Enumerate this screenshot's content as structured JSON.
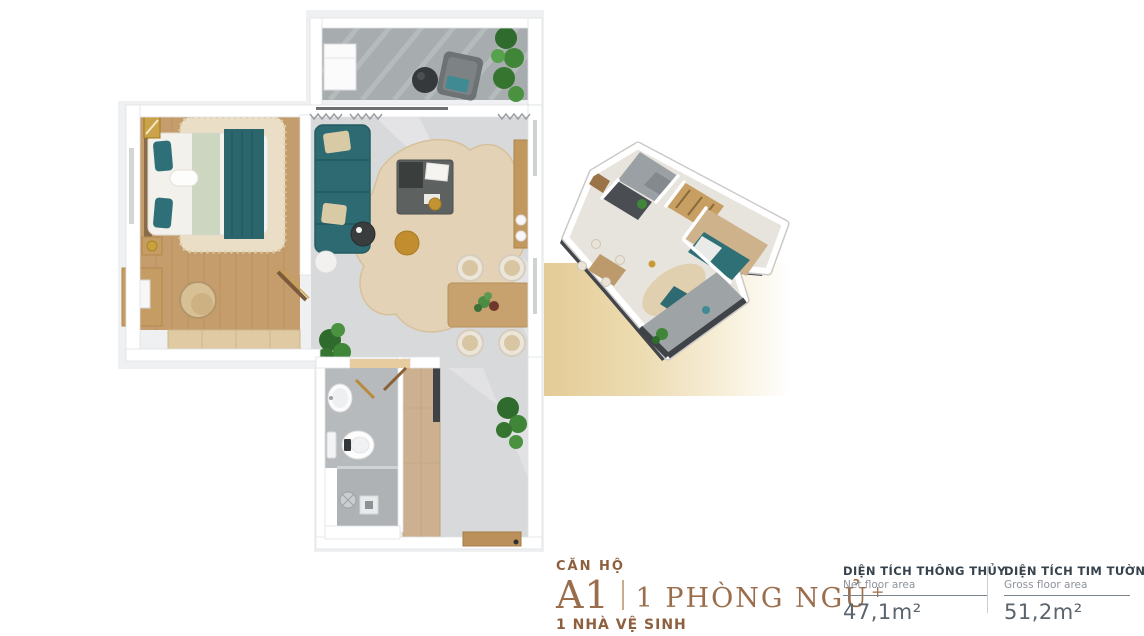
{
  "caption": {
    "heading": "CĂN HỘ",
    "unit_code": "A1",
    "bedroom_label": "1 PHÒNG NGỦ",
    "bedroom_suffix": "+",
    "bathroom_label": "1 NHÀ VỆ SINH"
  },
  "area_table": {
    "columns": [
      {
        "title": "DIỆN TÍCH THÔNG THỦY",
        "subtitle": "Net floor area",
        "value": "47,1m²"
      },
      {
        "title": "DIỆN TÍCH TIM TƯỜNG",
        "subtitle": "Gross floor area",
        "value": "51,2m²"
      }
    ]
  },
  "floor_plan": {
    "views": [
      "2d-top-view-render",
      "3d-isometric-cutaway-render"
    ],
    "rooms_depicted": [
      "bedroom",
      "living-room",
      "dining-area",
      "kitchen",
      "bathroom",
      "shower",
      "balcony",
      "hallway",
      "entrance"
    ]
  },
  "colors": {
    "accent_gold": "#9a6e4c",
    "caption_brown": "#8d5f3e",
    "band_gold": "#e4cb96",
    "table_title": "#36424c",
    "table_subtitle": "#8d939b",
    "table_value": "#5a646d",
    "table_rule": "#7b838b",
    "table_divider": "#c9ccd0",
    "teal_furniture": "#2d6a71",
    "wood_floor": "#c59d6c",
    "tile_gray": "#d8d9db",
    "deck_gray": "#a7acaf",
    "plant_green": "#3f8638",
    "brass_accent": "#c59432"
  }
}
